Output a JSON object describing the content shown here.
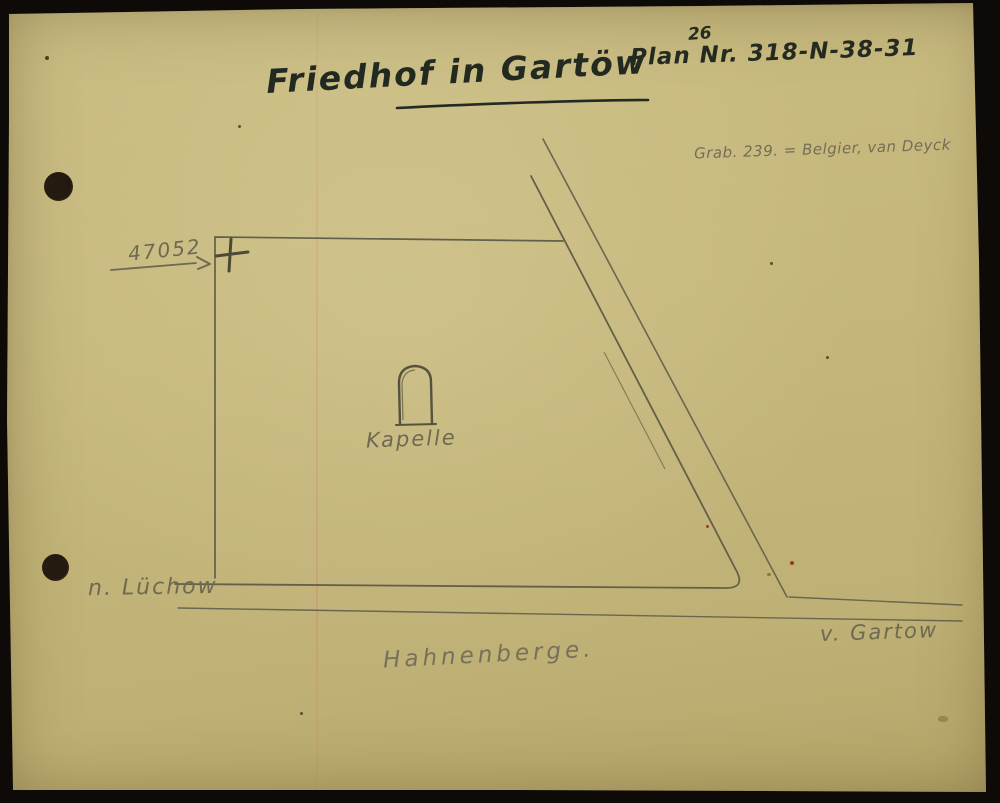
{
  "document": {
    "type": "scanned hand-drawn cemetery plan",
    "title": "Friedhof in Gartöw"
  },
  "plan_number": {
    "superscript": "26",
    "text": "Plan Nr. 318-N-38-31"
  },
  "grave_note": {
    "text": "Grab. 239. = Belgier, van Deyck"
  },
  "grave_marker": {
    "number": "47052",
    "symbol": "cross"
  },
  "map_labels": {
    "chapel": "Kapelle",
    "road_left": "n. Lüchow",
    "road_right": "v. Gartow",
    "area": "Hahnenberge."
  },
  "colors": {
    "paper": "#c6b87c",
    "ink": "#232a21",
    "pencil": "#6e6a52",
    "scan_background": "#0d0a07",
    "scan_streak_pink": "#cd7d73"
  }
}
